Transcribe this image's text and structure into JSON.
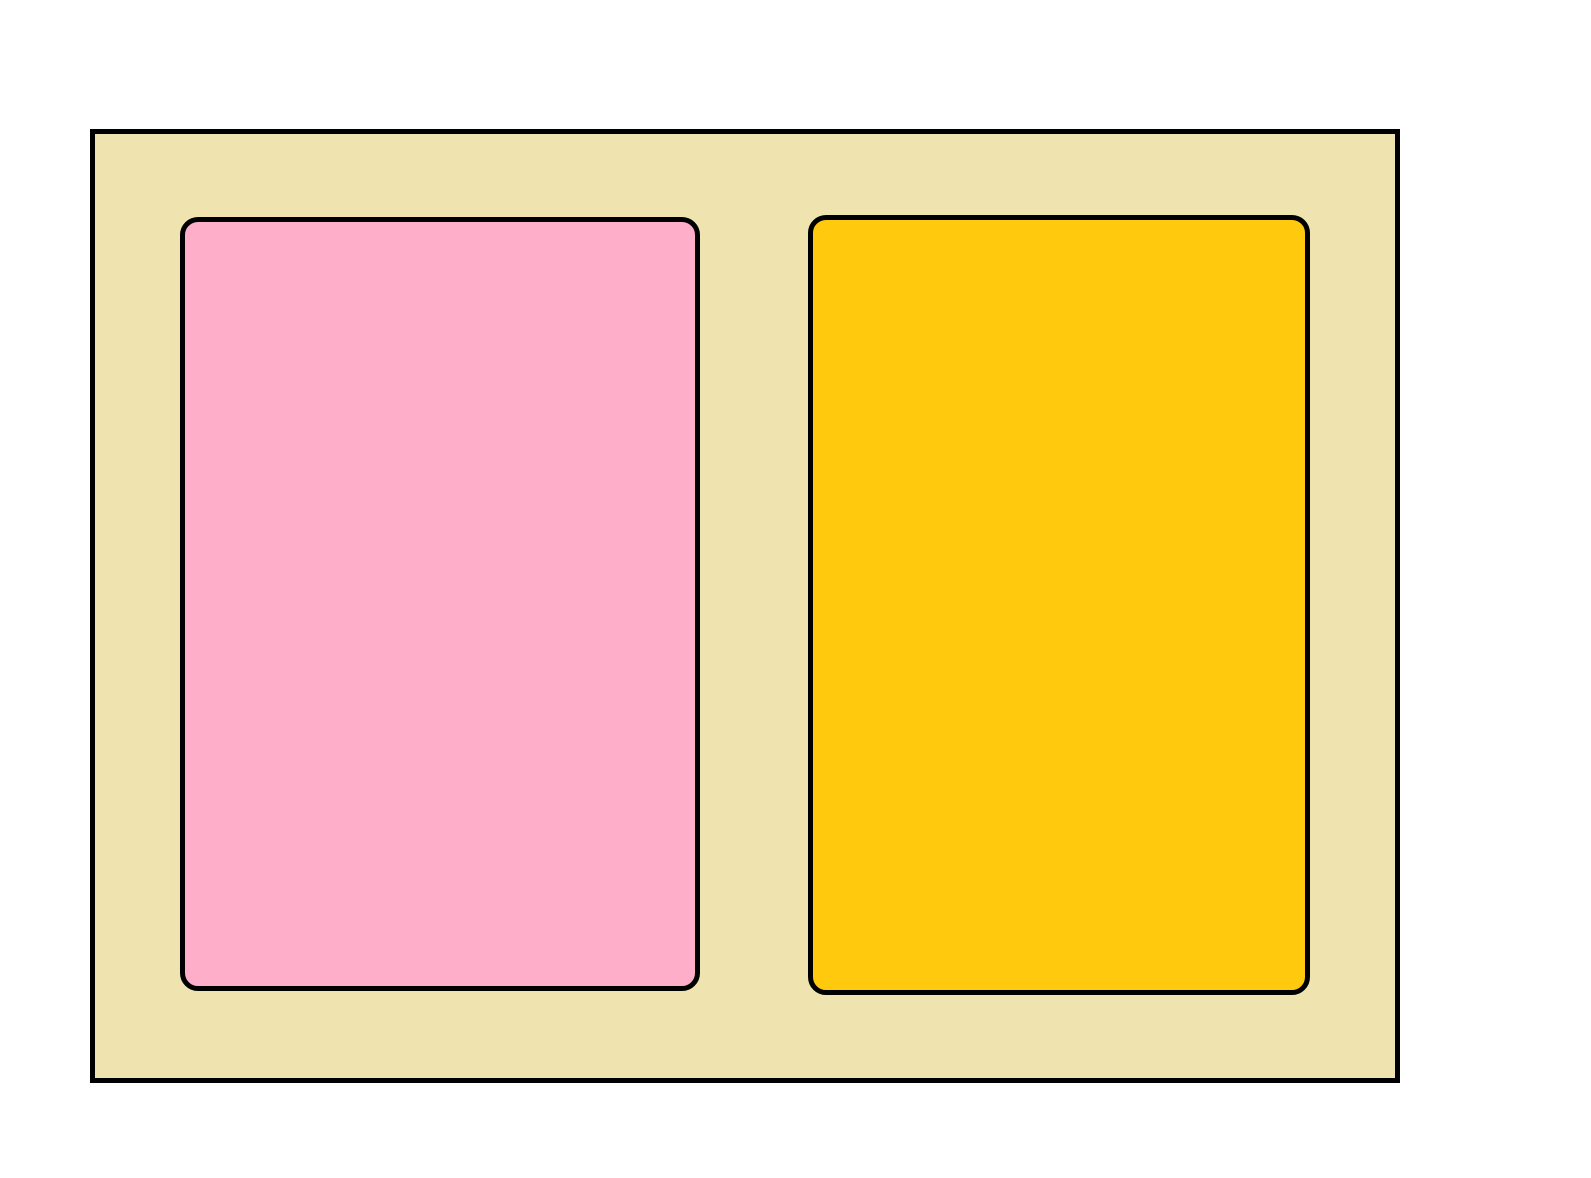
{
  "scene": {
    "background_color": "#FFFFFF",
    "stroke_color": "#000000",
    "panel": {
      "fill": "#EFE4B0"
    },
    "left_rectangle": {
      "fill": "#FFAEC9"
    },
    "right_rectangle": {
      "fill": "#FFC90E"
    }
  }
}
